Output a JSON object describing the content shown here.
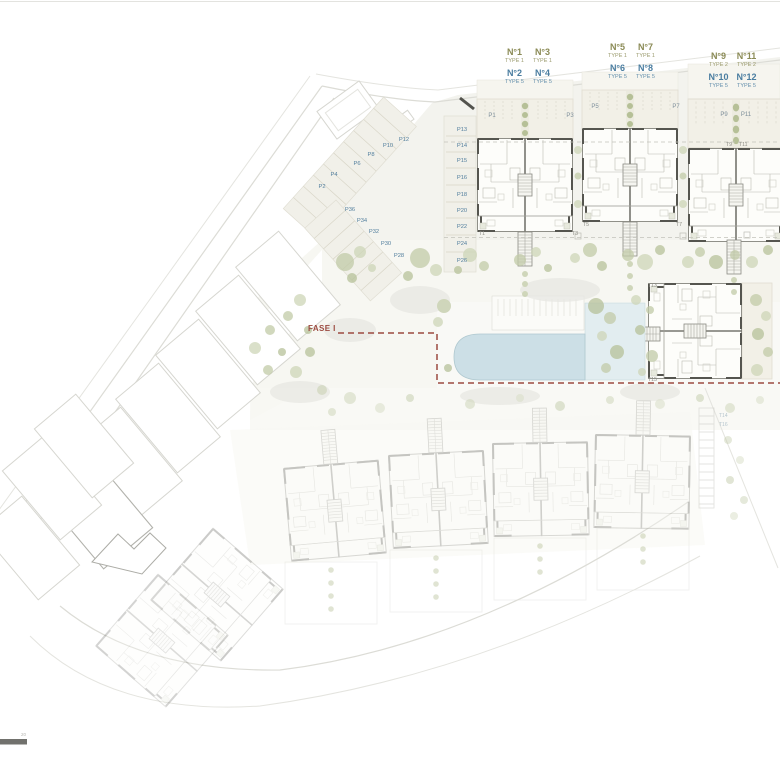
{
  "page": {
    "scale_label": "20"
  },
  "legend": {
    "groups": [
      {
        "cells": [
          {
            "no": "N°1",
            "type": "TYPE 1"
          },
          {
            "no": "N°3",
            "type": "TYPE 1"
          },
          {
            "no": "N°2",
            "type": "TYPE 5"
          },
          {
            "no": "N°4",
            "type": "TYPE 5"
          }
        ]
      },
      {
        "cells": [
          {
            "no": "N°5",
            "type": "TYPE 1"
          },
          {
            "no": "N°7",
            "type": "TYPE 1"
          },
          {
            "no": "N°6",
            "type": "TYPE 5"
          },
          {
            "no": "N°8",
            "type": "TYPE 5"
          }
        ]
      },
      {
        "cells": [
          {
            "no": "N°9",
            "type": "TYPE 2"
          },
          {
            "no": "N°11",
            "type": "TYPE 2"
          },
          {
            "no": "N°10",
            "type": "TYPE 5"
          },
          {
            "no": "N°12",
            "type": "TYPE 5"
          }
        ]
      }
    ],
    "colors": {
      "type_1_2": "#8a8a55",
      "type_5": "#4a7da0"
    }
  },
  "plan": {
    "phase_label": "FASE I",
    "phase_color": "#9c4a40",
    "plots": [
      "P1",
      "P3",
      "P5",
      "P7",
      "P9",
      "P11"
    ],
    "parking_column": [
      "P13",
      "P14",
      "P15",
      "P16",
      "P18",
      "P20",
      "P22",
      "P24",
      "P26"
    ],
    "parking_upper": [
      "P12",
      "P10",
      "P8",
      "P6",
      "P4",
      "P2"
    ],
    "parking_lower": [
      "P36",
      "P34",
      "P32",
      "P30",
      "P28"
    ],
    "terraces": [
      "T1",
      "T3",
      "T5",
      "T7",
      "T9",
      "T11",
      "T13",
      "T15"
    ],
    "terraces_faded": [
      "T14",
      "T16"
    ]
  }
}
